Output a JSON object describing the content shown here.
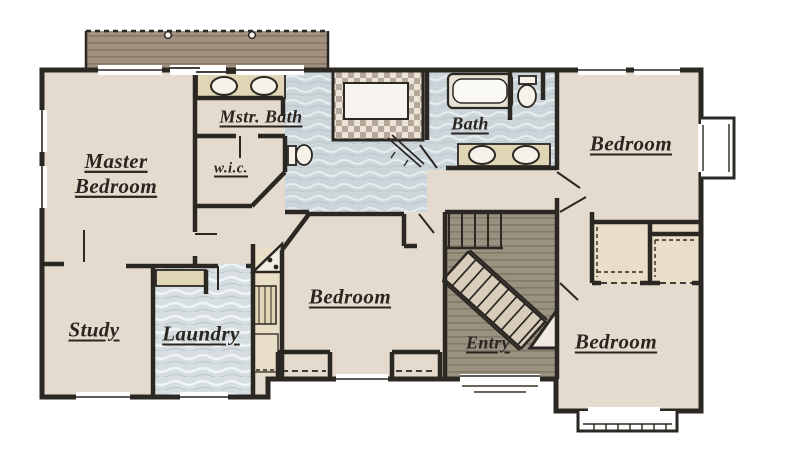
{
  "plan": {
    "rooms": {
      "master_bedroom": {
        "line1": "Master",
        "line2": "Bedroom"
      },
      "mstr_bath": {
        "label": "Mstr. Bath"
      },
      "wic": {
        "label": "w.i.c."
      },
      "bath": {
        "label": "Bath"
      },
      "bedroom_upper_right": {
        "label": "Bedroom"
      },
      "study": {
        "label": "Study"
      },
      "laundry": {
        "label": "Laundry"
      },
      "bedroom_center": {
        "label": "Bedroom"
      },
      "entry": {
        "label": "Entry"
      },
      "bedroom_lower_right": {
        "label": "Bedroom"
      }
    },
    "colors": {
      "wall": "#2b2723",
      "carpet": "#e4dbce",
      "bath_tile": "#ccd6da",
      "laundry_tile": "#d6dee1",
      "deck_wood": "#a3917f",
      "entry_wood": "#9a9180",
      "shower_checker_dark": "#b6a99a",
      "shower_checker_light": "#ece4d8",
      "counter": "#e0d5b4",
      "closet": "#e9dfc8",
      "stairs": "#d8cdbb",
      "label_text": "#2b2520"
    }
  }
}
